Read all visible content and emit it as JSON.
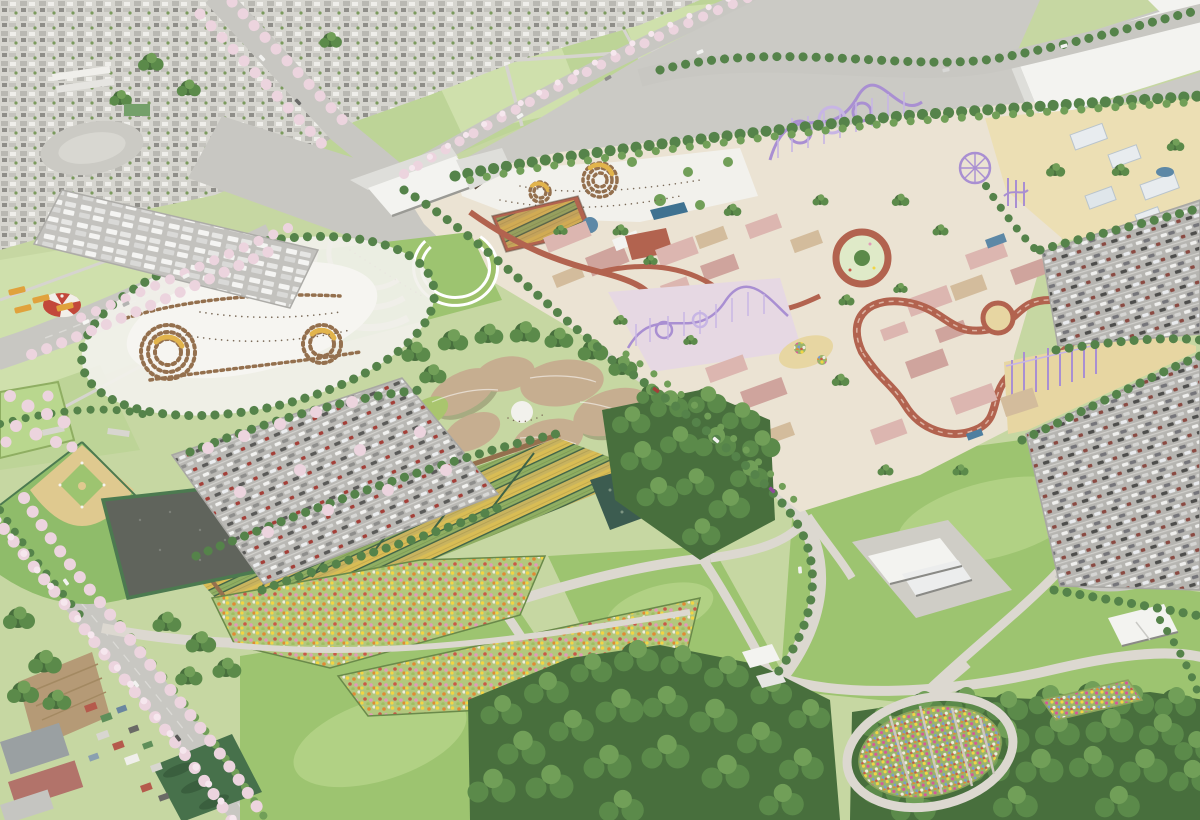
{
  "title": "Aerial rendering of a planned theme park resort surrounded by flower gardens, lawns, sports fields, farm fields, parking lots and a residential district",
  "palette": {
    "base": "#c6d7a2",
    "field": "#bdd497",
    "field2": "#cfe0ac",
    "lawn": "#9dc470",
    "lawn2": "#b1d184",
    "forest1": "#486f3d",
    "forest2": "#5b8a4a",
    "forest3": "#719f58",
    "hedge": "#55834a",
    "road": "#c8c7c2",
    "road2": "#d6d4cf",
    "path": "#dcd8d0",
    "vacant": "#cbcac5",
    "asphalt": "#b9b8b4",
    "urban": "#d4d3cd",
    "plaza": "#f2f1ec",
    "parkground": "#ebe3d3",
    "sand": "#e7d6a2",
    "sand2": "#ecdfb4",
    "white": "#f3f3f0",
    "shade": "#dededa",
    "pink": "#dcb6b0",
    "pink2": "#cfa49d",
    "tan": "#d3bc9c",
    "petal": "#c6ae90",
    "petalg": "#a9c56e",
    "purple": "#a98fd2",
    "purple2": "#c7b5e4",
    "lavender": "#e6d8e3",
    "redpath": "#b2634f",
    "tentred": "#c2483b",
    "pond": "#5d88a6",
    "ponddark": "#3c5c50",
    "blossom": "#ecd4de",
    "blossom2": "#f6e7ee",
    "infield": "#dfc98f",
    "outfield": "#8fbc6a",
    "court": "#60645c",
    "net": "#4c7a50",
    "cropY": "#d9bd55",
    "cropG": "#8fae62",
    "cropO": "#c8b35e",
    "cropD": "#3f6347",
    "meadow": "#b2c77d",
    "fYellow": "#f2d544",
    "fOrange": "#e08a35",
    "fRed": "#c85948",
    "fPink": "#e29ab8",
    "fWhite": "#efece0",
    "fBlue": "#7a9ad0",
    "brown": "#94704e",
    "crescent": "#e2b44c",
    "dirt": "#b59a76",
    "orchard": "#47714b",
    "crowd": "#7a6a58",
    "busYellow": "#e0a23c"
  },
  "scene": {
    "description": "Bird's-eye watercolor-style site plan. A fenced theme park with pink-roofed pavilions, purple roller coasters, a ferris wheel and looping kart track sits at center-right; a petal-roofed hall, striped crop gardens, a dotted flower meadow, great lawns, a circular flower garden and forest groves fill the public park below; baseball field, netted courts, an oval festival ground, car parks, farm fields, a logistics warehouse and a residential district surround it, laced with cherry-blossom avenues.",
    "areas": [
      {
        "id": "residential-district",
        "label": "Residential district"
      },
      {
        "id": "school-campus",
        "label": "School campus"
      },
      {
        "id": "farm-fields",
        "label": "Farm fields"
      },
      {
        "id": "vacant-lots",
        "label": "Vacant gravel lots"
      },
      {
        "id": "logistics-warehouse",
        "label": "Logistics warehouse"
      },
      {
        "id": "cherry-avenue",
        "label": "Cherry blossom avenues"
      },
      {
        "id": "bus-terminal-parking",
        "label": "Bus terminal parking"
      },
      {
        "id": "circus-tent",
        "label": "Circus tent"
      },
      {
        "id": "festival-oval",
        "label": "Festival oval with market stalls"
      },
      {
        "id": "entrance-gate",
        "label": "Park entrance gate"
      },
      {
        "id": "festival-plaza",
        "label": "Festival plaza"
      },
      {
        "id": "theme-park",
        "label": "Theme park with pink-roofed buildings"
      },
      {
        "id": "roller-coasters",
        "label": "Purple roller coasters"
      },
      {
        "id": "ferris-wheel",
        "label": "Ferris wheel"
      },
      {
        "id": "central-circle-plaza",
        "label": "Central circle plaza"
      },
      {
        "id": "kart-track",
        "label": "Looping kart track"
      },
      {
        "id": "drop-towers",
        "label": "Purple drop towers"
      },
      {
        "id": "petal-hall",
        "label": "Petal-roofed hall"
      },
      {
        "id": "crop-gardens",
        "label": "Striped crop gardens"
      },
      {
        "id": "biotope-pond",
        "label": "Biotope pond"
      },
      {
        "id": "flower-meadow",
        "label": "Flower meadow"
      },
      {
        "id": "circular-flower-garden",
        "label": "Circular flower garden"
      },
      {
        "id": "great-lawn",
        "label": "Great lawns"
      },
      {
        "id": "forest-grove",
        "label": "Forest groves"
      },
      {
        "id": "museum-building",
        "label": "Museum building"
      },
      {
        "id": "park-pavilion",
        "label": "Park pavilion"
      },
      {
        "id": "baseball-field",
        "label": "Baseball field"
      },
      {
        "id": "netted-courts",
        "label": "Netted sports courts"
      },
      {
        "id": "main-parking",
        "label": "Visitor parking lots"
      },
      {
        "id": "village",
        "label": "Roadside village"
      },
      {
        "id": "orchard",
        "label": "Orchard"
      },
      {
        "id": "factory",
        "label": "Factory building"
      }
    ]
  }
}
